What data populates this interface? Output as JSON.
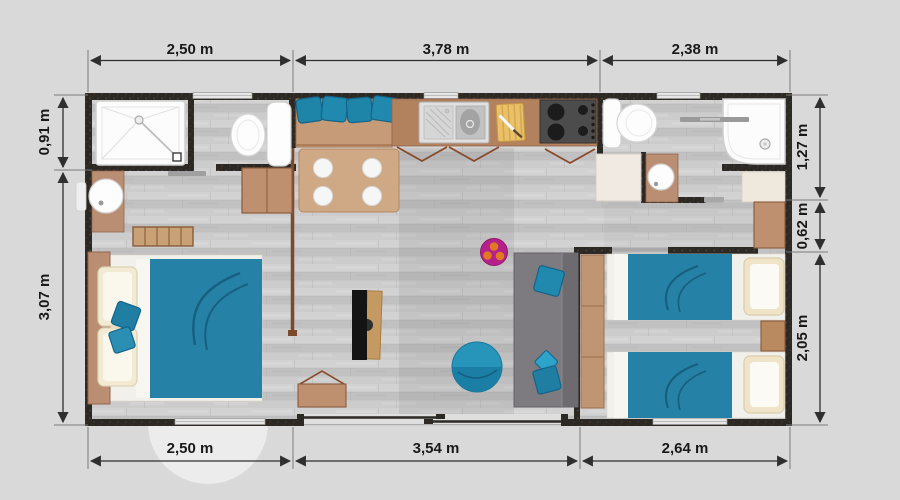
{
  "plan": {
    "type": "floor-plan",
    "units": "m",
    "dims": {
      "top": [
        "2,50 m",
        "3,78 m",
        "2,38 m"
      ],
      "bottom": [
        "2,50 m",
        "3,54 m",
        "2,64 m"
      ],
      "left": [
        "0,91 m",
        "3,07 m"
      ],
      "right": [
        "1,27 m",
        "0,62 m",
        "2,05 m"
      ]
    },
    "colors": {
      "background": "#d9d9d9",
      "wall": "#2c2824",
      "floor": "#c9c9c9",
      "wood_furniture": "#bf9070",
      "kitchen_counter": "#b2825f",
      "accent_teal": "#2185a8",
      "sofa_gray": "#7d7b80",
      "rug_magenta": "#b5208a",
      "rug_dots_orange": "#e07a20",
      "sanitary_white": "#fcfcfc",
      "dimension_text": "#191919"
    },
    "furniture_icons": [
      "shower-icon",
      "toilet-icon",
      "washbasin-icon",
      "towel-ladder-icon",
      "double-bed-icon",
      "pillow-icon",
      "cushion-icon",
      "dresser-icon",
      "bench-seat-icon",
      "dining-table-icon",
      "plate-icon",
      "kitchen-sink-icon",
      "cutting-board-icon",
      "stove-icon",
      "tv-icon",
      "tv-stand-icon",
      "cabinet-icon",
      "rug-icon",
      "pouf-icon",
      "sofa-icon",
      "shower-2-icon",
      "toilet-2-icon",
      "washbasin-2-icon",
      "wardrobe-icon",
      "twin-bed-icon",
      "nightstand-icon",
      "sliding-door-icon",
      "window-icon",
      "door-swing-icon"
    ]
  }
}
